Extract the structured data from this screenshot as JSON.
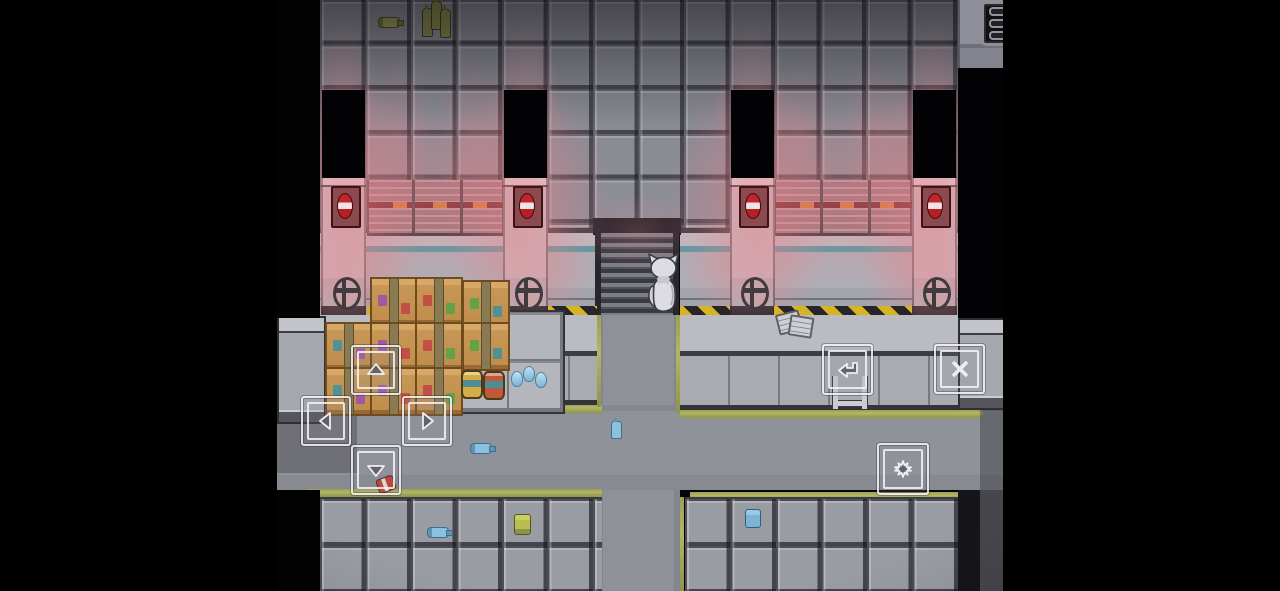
{
  "window": {
    "width": 1280,
    "height": 591,
    "viewport_left": 277,
    "viewport_width": 726
  },
  "app": {
    "type": "top-down-adventure-game",
    "scene": "warehouse-interior-with-alarm-lights"
  },
  "palette": {
    "letterbox": "#000000",
    "panel_gray": "#8f8f99",
    "frame_dark": "#55555d",
    "wall_gray": "#aeaeb6",
    "cyan_stripe": "#579aa4",
    "olive_edge": "#a9ad5f",
    "hazard_yellow": "#d8b322",
    "hazard_black": "#26262a",
    "glow_pink": "#f08088",
    "alarm_red": "#c2242c",
    "alarm_white": "#eee4e4",
    "crate_tan": "#c89755",
    "barrel_yellow": "#d6ac45",
    "barrel_red": "#c0593a",
    "bottle_blue": "#7ab4d6",
    "floor_gray": "#8f9199",
    "button_stroke": "rgba(244,244,248,0.85)"
  },
  "hud": {
    "menu_button": {
      "id": "menu",
      "icon": "hamburger-menu-icon",
      "x": 704,
      "y": 1,
      "w": 46,
      "h": 45,
      "bars": 3
    },
    "dpad": [
      {
        "id": "up",
        "icon": "arrow-up-icon",
        "x": 74,
        "y": 345,
        "w": 46,
        "h": 46
      },
      {
        "id": "left",
        "icon": "arrow-left-icon",
        "x": 24,
        "y": 396,
        "w": 46,
        "h": 46
      },
      {
        "id": "right",
        "icon": "arrow-right-icon",
        "x": 125,
        "y": 396,
        "w": 46,
        "h": 46
      },
      {
        "id": "down",
        "icon": "arrow-down-icon",
        "x": 74,
        "y": 445,
        "w": 46,
        "h": 46
      }
    ],
    "actions": [
      {
        "id": "confirm",
        "icon": "return-arrow-icon",
        "x": 545,
        "y": 344,
        "w": 47,
        "h": 47
      },
      {
        "id": "cancel",
        "icon": "x-icon",
        "x": 657,
        "y": 344,
        "w": 47,
        "h": 46
      },
      {
        "id": "settings",
        "icon": "star-burst-icon",
        "x": 600,
        "y": 443,
        "w": 48,
        "h": 48
      }
    ]
  },
  "scene": {
    "player": {
      "sprite": "white-cat",
      "facing": "up",
      "x": 368,
      "y": 251,
      "w": 37,
      "h": 62
    },
    "glow_rgb": "240,128,136",
    "glows": [
      {
        "x": 67,
        "y": 205,
        "rx": 85,
        "ry": 125,
        "a": 0.55
      },
      {
        "x": 249,
        "y": 205,
        "rx": 85,
        "ry": 125,
        "a": 0.5
      },
      {
        "x": 475,
        "y": 205,
        "rx": 85,
        "ry": 125,
        "a": 0.5
      },
      {
        "x": 657,
        "y": 205,
        "rx": 85,
        "ry": 125,
        "a": 0.55
      },
      {
        "x": 158,
        "y": 200,
        "rx": 120,
        "ry": 90,
        "a": 0.38
      },
      {
        "x": 566,
        "y": 200,
        "rx": 120,
        "ry": 90,
        "a": 0.38
      },
      {
        "x": 67,
        "y": 115,
        "rx": 38,
        "ry": 90,
        "a": 0.3
      },
      {
        "x": 249,
        "y": 115,
        "rx": 38,
        "ry": 90,
        "a": 0.28
      },
      {
        "x": 475,
        "y": 115,
        "rx": 38,
        "ry": 90,
        "a": 0.28
      },
      {
        "x": 657,
        "y": 115,
        "rx": 38,
        "ry": 90,
        "a": 0.3
      },
      {
        "x": 120,
        "y": 135,
        "rx": 42,
        "ry": 75,
        "a": 0.22
      },
      {
        "x": 196,
        "y": 135,
        "rx": 42,
        "ry": 75,
        "a": 0.22
      },
      {
        "x": 524,
        "y": 135,
        "rx": 42,
        "ry": 75,
        "a": 0.22
      },
      {
        "x": 600,
        "y": 135,
        "rx": 42,
        "ry": 75,
        "a": 0.22
      },
      {
        "x": 67,
        "y": 275,
        "rx": 75,
        "ry": 60,
        "a": 0.35
      },
      {
        "x": 657,
        "y": 275,
        "rx": 75,
        "ry": 60,
        "a": 0.35
      },
      {
        "x": 249,
        "y": 268,
        "rx": 70,
        "ry": 55,
        "a": 0.3
      },
      {
        "x": 475,
        "y": 268,
        "rx": 70,
        "ry": 55,
        "a": 0.3
      },
      {
        "x": 362,
        "y": 232,
        "rx": 60,
        "ry": 40,
        "a": 0.22
      }
    ],
    "shutters": [
      {
        "x": 90,
        "w": 137
      },
      {
        "x": 497,
        "w": 138
      }
    ],
    "pillars": [
      {
        "x": 44
      },
      {
        "x": 226
      },
      {
        "x": 453
      },
      {
        "x": 635
      }
    ],
    "door_openings_top": [
      {
        "x": 45
      },
      {
        "x": 227
      },
      {
        "x": 454
      },
      {
        "x": 636
      }
    ],
    "alarm_lights": [
      {
        "x": 54
      },
      {
        "x": 236
      },
      {
        "x": 462
      },
      {
        "x": 644
      }
    ],
    "valve_wheels": [
      {
        "x": 56
      },
      {
        "x": 238
      },
      {
        "x": 464
      },
      {
        "x": 646
      }
    ],
    "hazard_stripes": [
      {
        "x": 90,
        "w": 137
      },
      {
        "x": 271,
        "w": 49
      },
      {
        "x": 403,
        "w": 50
      },
      {
        "x": 497,
        "w": 138
      }
    ],
    "crates": [
      {
        "x": 93,
        "y": 277
      },
      {
        "x": 138,
        "y": 277
      },
      {
        "x": 185,
        "y": 280
      },
      {
        "x": 48,
        "y": 322
      },
      {
        "x": 93,
        "y": 322
      },
      {
        "x": 138,
        "y": 322
      },
      {
        "x": 185,
        "y": 322
      },
      {
        "x": 48,
        "y": 367
      },
      {
        "x": 93,
        "y": 367
      },
      {
        "x": 138,
        "y": 367
      }
    ],
    "stamp_colors": [
      "#9a4fb0",
      "#c24343",
      "#52a447",
      "#3f8fa0"
    ],
    "shelf_unit": {
      "x": 178,
      "y": 310,
      "w": 106,
      "h": 100
    },
    "barrels": [
      {
        "x": 184,
        "y": 370,
        "color": "#d6ac45"
      },
      {
        "x": 206,
        "y": 371,
        "color": "#c0593a"
      }
    ],
    "water_drops": {
      "x": 234,
      "y": 366
    },
    "cabinets": [
      {
        "x": 0,
        "y": 316,
        "w": 45,
        "h": 104
      },
      {
        "x": 681,
        "y": 318,
        "w": 45,
        "h": 88
      }
    ],
    "papers": {
      "x": 500,
      "y": 312
    },
    "ladder": {
      "x": 556,
      "y": 376
    },
    "top_shelf_items": {
      "lying_bottle": {
        "x": 101,
        "y": 17
      },
      "bottle_cluster": {
        "x": 145,
        "y": 1
      }
    },
    "floor_items": [
      {
        "type": "bottle-lying",
        "x": 193,
        "y": 443
      },
      {
        "type": "bottle-standing",
        "x": 334,
        "y": 421
      },
      {
        "type": "red-can",
        "x": 100,
        "y": 477
      },
      {
        "type": "bottle-lying",
        "x": 150,
        "y": 527
      },
      {
        "type": "can-yellow",
        "x": 237,
        "y": 514
      },
      {
        "type": "can-blue",
        "x": 468,
        "y": 509
      }
    ],
    "door_openings_bottom": [
      {
        "x": 45
      },
      {
        "x": 228
      },
      {
        "x": 455
      },
      {
        "x": 634
      }
    ],
    "inset_cells_bottom": [
      {
        "x": 93
      },
      {
        "x": 138
      },
      {
        "x": 183
      },
      {
        "x": 501
      },
      {
        "x": 545
      },
      {
        "x": 588
      }
    ]
  }
}
